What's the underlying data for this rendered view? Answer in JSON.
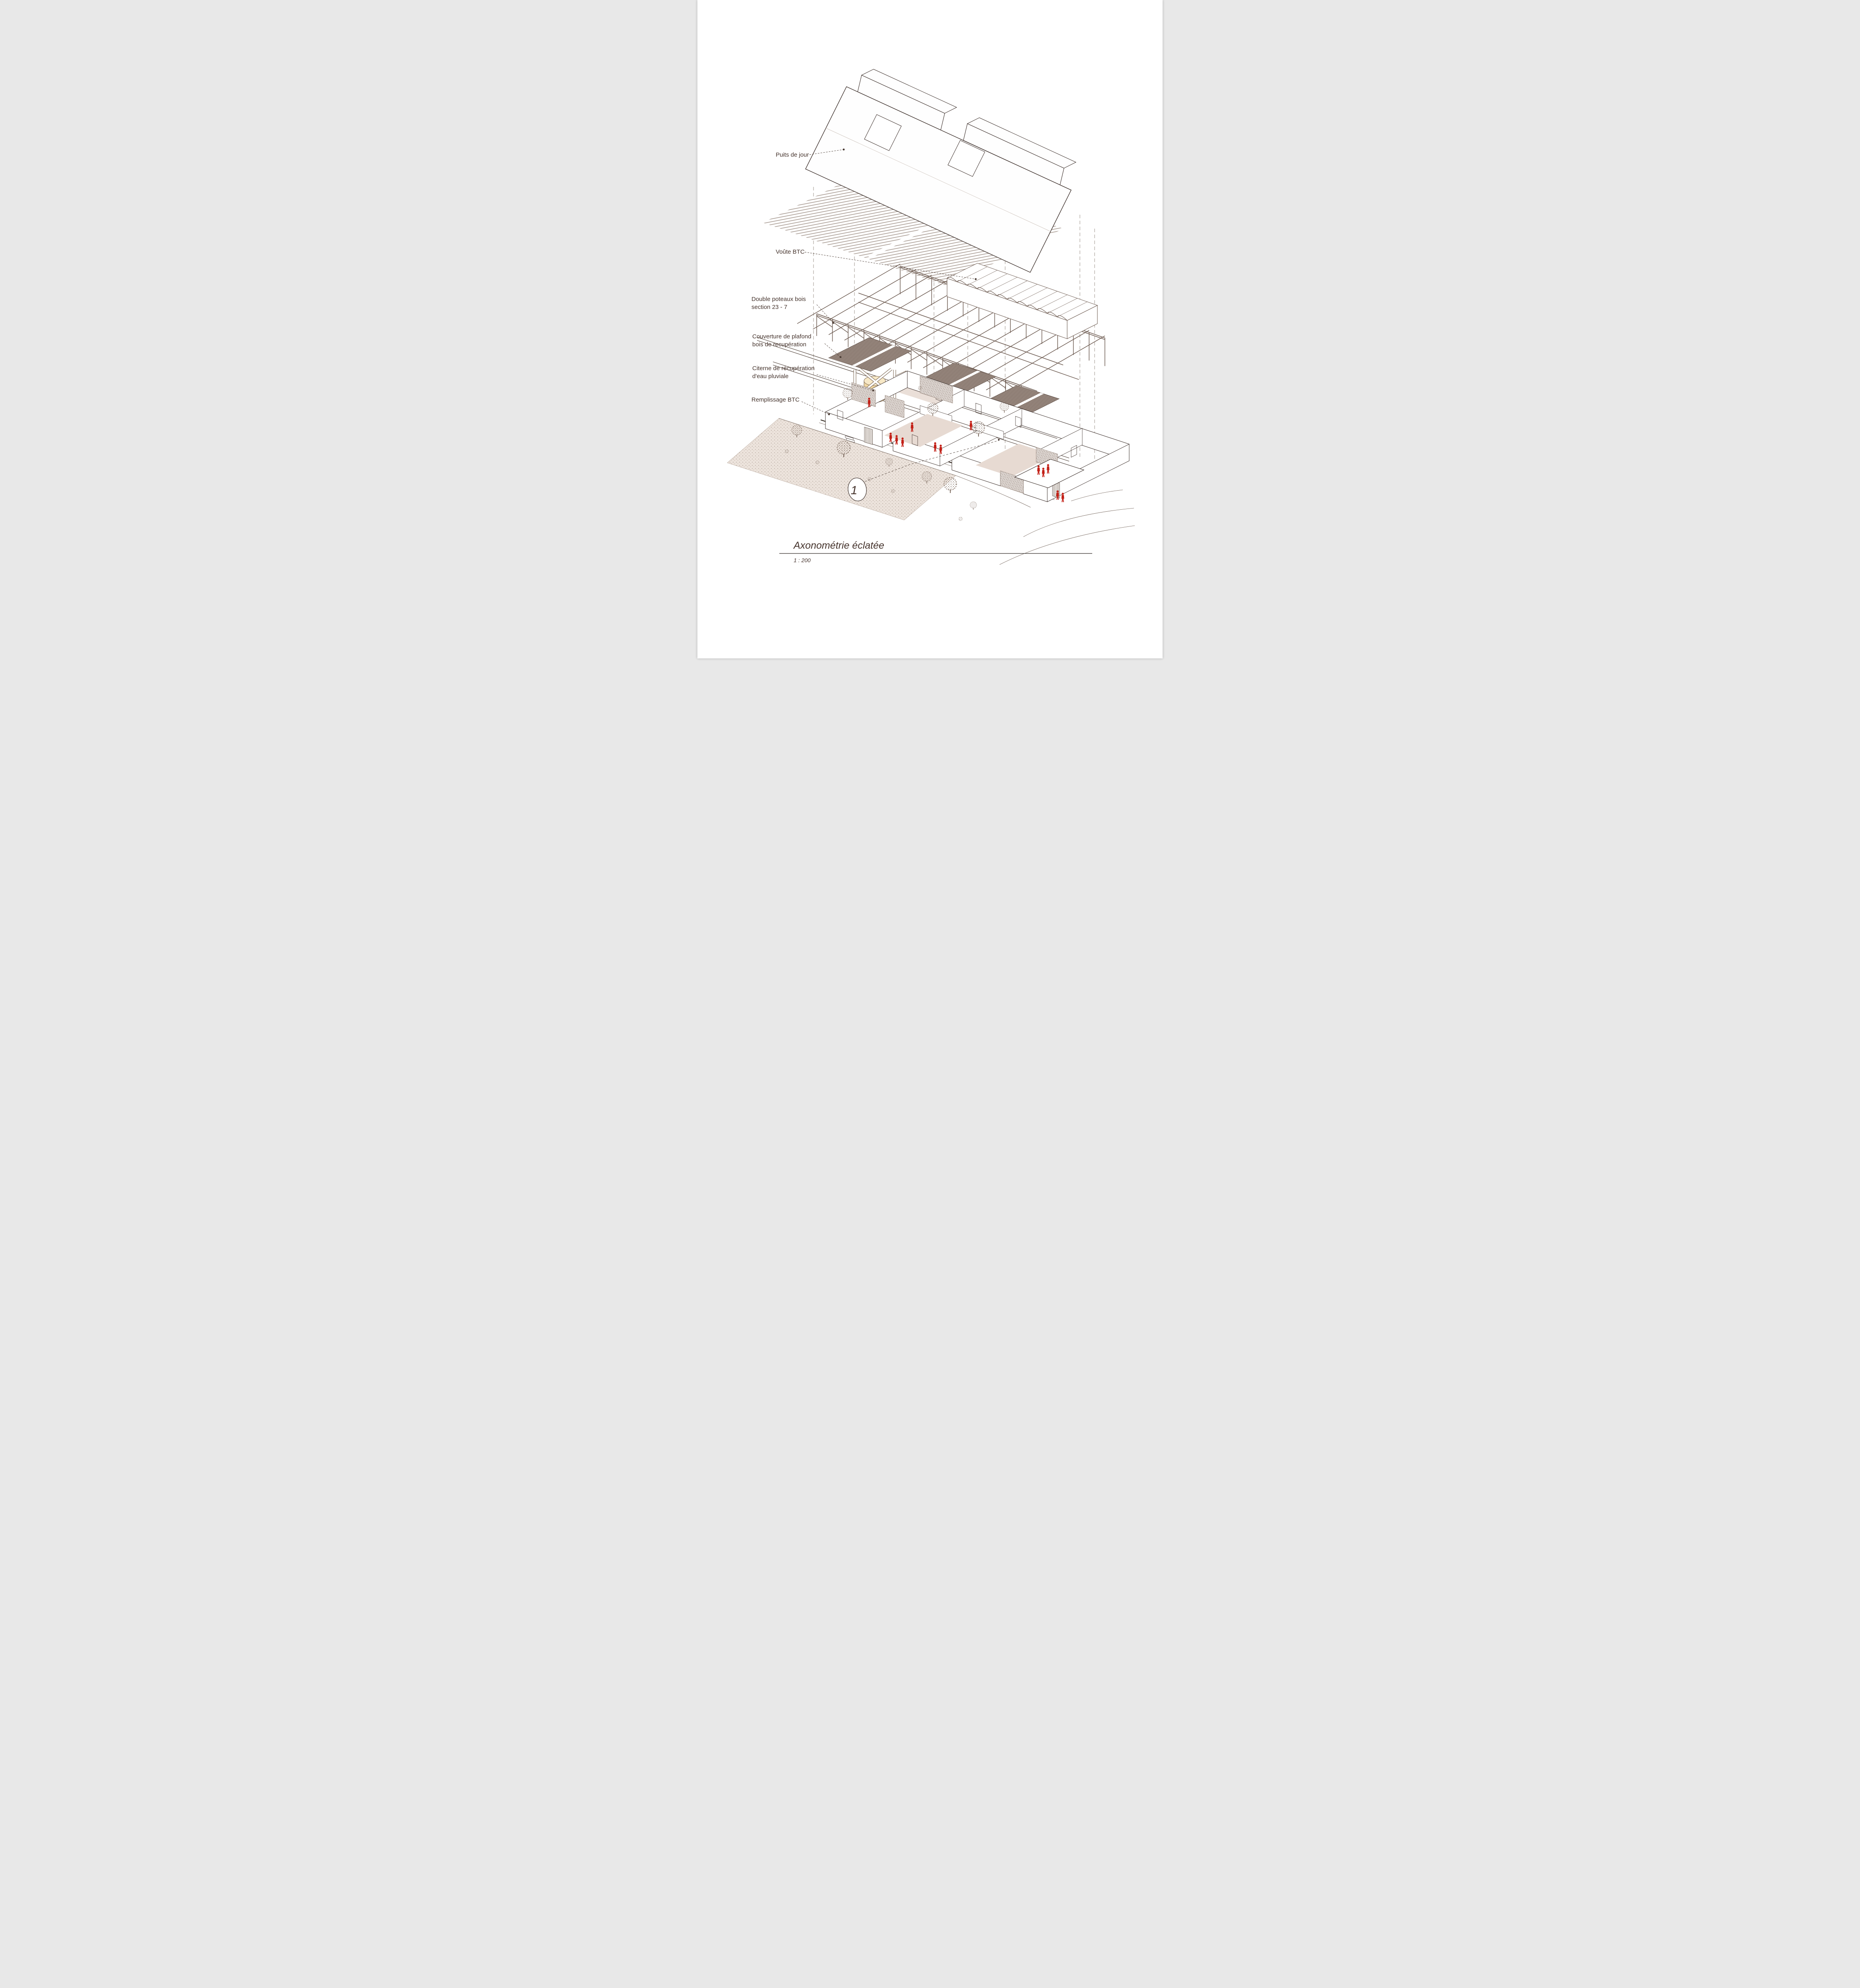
{
  "callouts": [
    {
      "id": "puits-de-jour",
      "lines": [
        "Puits de jour"
      ]
    },
    {
      "id": "voute-btc",
      "lines": [
        "Voûte BTC"
      ]
    },
    {
      "id": "double-poteaux",
      "lines": [
        "Double poteaux bois",
        "section 23 - 7"
      ]
    },
    {
      "id": "couverture",
      "lines": [
        "Couverture de plafond",
        "bois de recupération"
      ]
    },
    {
      "id": "citerne",
      "lines": [
        "Citerne de récupération",
        "d'eau pluviale"
      ]
    },
    {
      "id": "remplissage",
      "lines": [
        "Remplissage BTC"
      ]
    }
  ],
  "marker": {
    "number": "1"
  },
  "titleblock": {
    "title": "Axonométrie éclatée",
    "scale": "1 : 200"
  },
  "colors": {
    "ink": "#3a2d28",
    "label_text": "#45332c",
    "figures_red": "#c32017",
    "ground_stipple": "#ece3dc",
    "courtyard_pink": "#e7dad2",
    "ceiling_panel": "#a3938a",
    "cistern_tan": "#f0d6a0",
    "timber": "#6f5d53"
  }
}
